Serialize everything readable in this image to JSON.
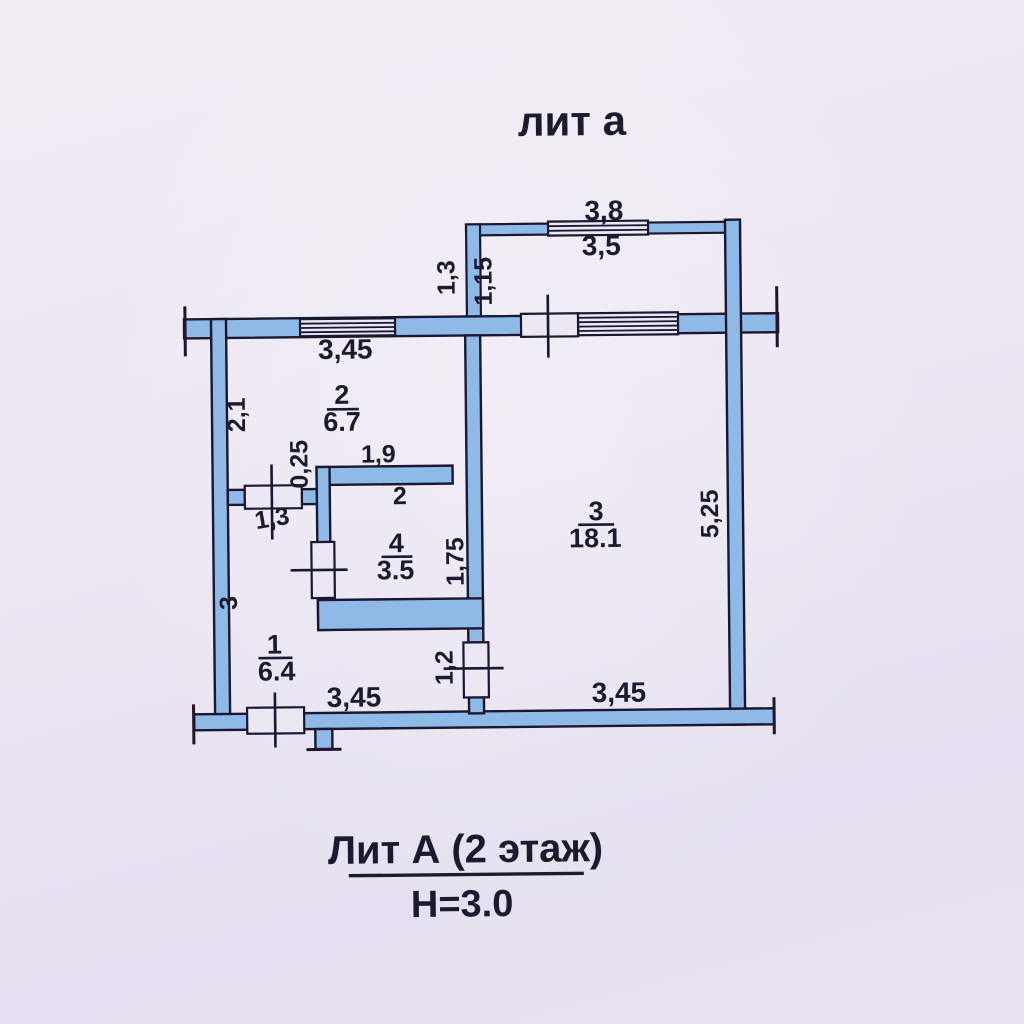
{
  "header": {
    "title": "лит а"
  },
  "footer": {
    "title": "Лит А (2 этаж)",
    "height_note": "Н=3.0"
  },
  "rooms": {
    "room1": {
      "num": "1",
      "area": "6.4"
    },
    "room2": {
      "num": "2",
      "area": "6.7"
    },
    "room3": {
      "num": "3",
      "area": "18.1"
    },
    "room4": {
      "num": "4",
      "area": "3.5"
    }
  },
  "dimensions": {
    "balcony_width_outer": "3,8",
    "balcony_width_inner": "3,5",
    "balcony_depth_outer": "1,3",
    "balcony_depth_inner": "1,15",
    "room2_window_wall": "3,45",
    "room2_left_wall": "2,1",
    "pier_width": "0,25",
    "room4_top_wall": "1,9",
    "room4_top_inner": "2",
    "room2_door_width": "1,3",
    "room4_right_wall": "1,75",
    "room3_right_wall": "5,25",
    "room1_left_wall": "3",
    "room3_door_width": "1,2",
    "bottom_wall_left": "3,45",
    "bottom_wall_right": "3,45"
  },
  "colors": {
    "wall_fill": "#8fbae8",
    "outline": "#191731",
    "paper": "#ebe6f2"
  }
}
